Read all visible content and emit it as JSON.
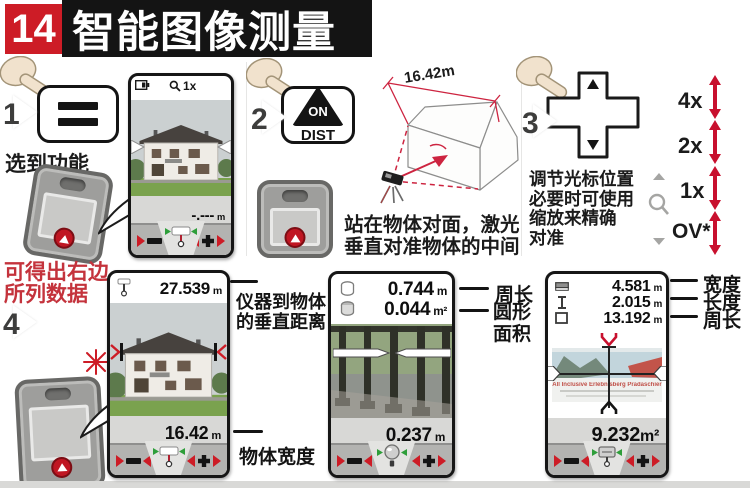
{
  "header": {
    "page_num": "14",
    "title": "智能图像测量"
  },
  "step1": {
    "num": "1",
    "caption": "选到功能",
    "screen_zoom": "1x",
    "screen_value": "-.---",
    "screen_unit": "m"
  },
  "step2": {
    "num": "2",
    "button_top": "ON",
    "button_bottom": "DIST",
    "dimension": "16.42m",
    "caption_line1": "站在物体对面，激光",
    "caption_line2": "垂直对准物体的中间"
  },
  "step3": {
    "num": "3",
    "caption_line1": "调节光标位置",
    "caption_line2": "必要时可使用",
    "caption_line3": "缩放来精确",
    "caption_line4": "对准",
    "zoom1": "4x",
    "zoom2": "2x",
    "zoom3": "1x",
    "zoom4": "OV*"
  },
  "step4": {
    "num": "4",
    "note_line1": "可得出右边",
    "note_line2": "所列数据",
    "top_value": "27.539",
    "top_unit": "m",
    "bottom_value": "16.42",
    "bottom_unit": "m",
    "label_vert_line1": "仪器到物体",
    "label_vert_line2": "的垂直距离",
    "label_width": "物体宽度"
  },
  "circle_screen": {
    "row1_value": "0.744",
    "row1_unit": "m",
    "row1_label": "周长",
    "row2_value": "0.044",
    "row2_unit": "m²",
    "row2_label_line1": "圆形",
    "row2_label_line2": "面积",
    "bottom_value": "0.237",
    "bottom_unit": "m"
  },
  "area_screen": {
    "row1_value": "4.581",
    "row1_unit": "m",
    "row1_label": "宽度",
    "row2_value": "2.015",
    "row2_unit": "m",
    "row2_label": "长度",
    "row3_value": "13.192",
    "row3_unit": "m",
    "row3_label": "周长",
    "bottom_value": "9.232",
    "bottom_unit": "m²",
    "billboard_text": "All Inclusive Erlebnisberg Pradaschier"
  }
}
